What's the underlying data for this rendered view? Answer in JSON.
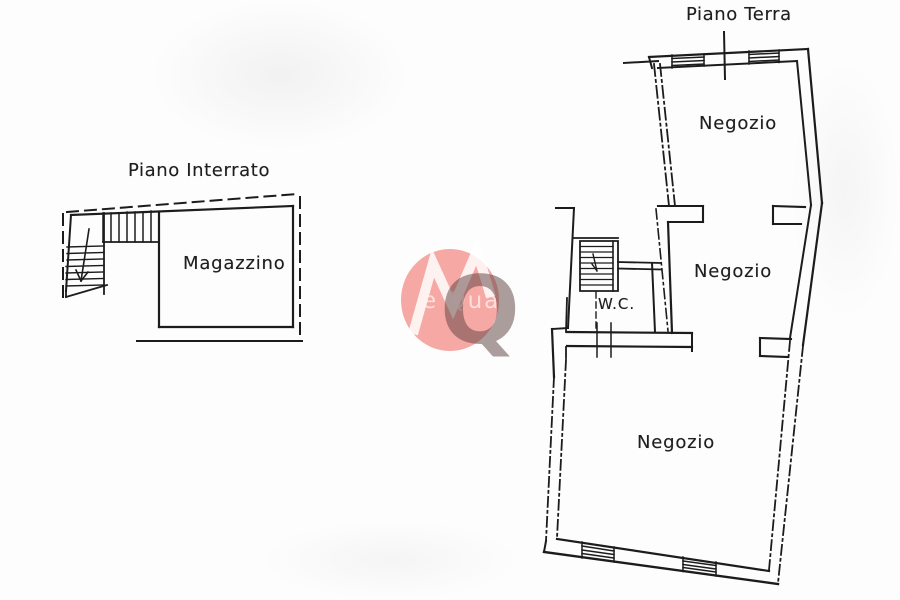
{
  "colors": {
    "ink": "#1c1c1c",
    "background": "#fdfdfd",
    "watermark_red": "#f2837e",
    "watermark_q": "#6e5450"
  },
  "plans": {
    "interrato": {
      "title": "Piano Interrato",
      "room": "Magazzino"
    },
    "terra": {
      "title": "Piano Terra",
      "shop1": "Negozio",
      "shop2": "Negozio",
      "wc": "W.C.",
      "shop3": "Negozio"
    }
  },
  "watermark": {
    "text": "e Qua",
    "monogram": "Q"
  }
}
